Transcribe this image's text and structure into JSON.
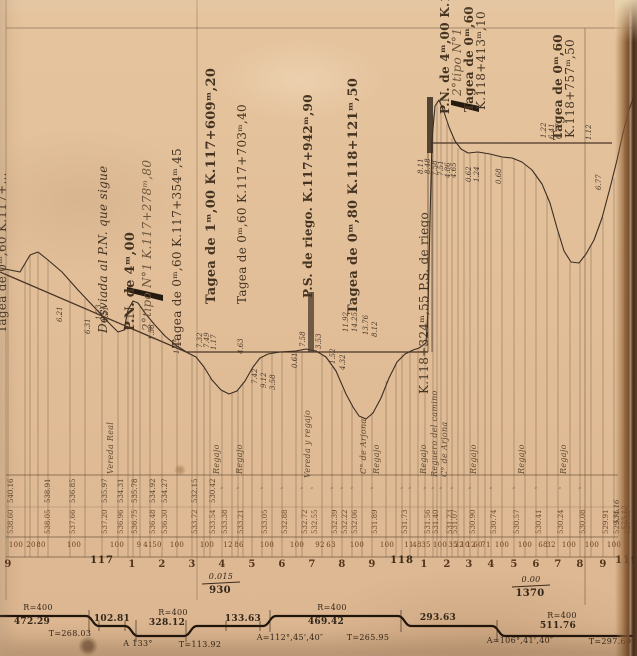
{
  "palette": {
    "paper": "#e2bf99",
    "ink": "#443320",
    "terrain_line": "#3b2e22",
    "grade_line": "#4a3527",
    "band_line": "#20150c",
    "edge_brown": "#55341d"
  },
  "structures": [
    {
      "v": "Tagea de 0ᵐ,60  K.117+…",
      "x": -4,
      "y": 333,
      "c": "s11"
    },
    {
      "v": "Desviada al P.N. que sigue",
      "x": 97,
      "y": 333,
      "c": "i s12"
    },
    {
      "v": "P.N. de 4ᵐ,00",
      "x": 124,
      "y": 331,
      "c": "b s13"
    },
    {
      "v": "2°tipo N°1   K.117+278ᵐ,80",
      "x": 141,
      "y": 331,
      "c": "i s9 faded"
    },
    {
      "v": "Tagea de 0ᵐ,60 K.117+354ᵐ,45",
      "x": 171,
      "y": 348,
      "c": "s12"
    },
    {
      "v": "Tagea de 1ᵐ,00  K.117+609ᵐ,20",
      "x": 205,
      "y": 304,
      "c": "b s13"
    },
    {
      "v": "Tagea de 0ᵐ,60 K.117+703ᵐ,40",
      "x": 236,
      "y": 304,
      "c": "s12"
    },
    {
      "v": "P.S. de riego.  K.117+942ᵐ,90",
      "x": 302,
      "y": 298,
      "c": "b s12"
    },
    {
      "v": "Tagea de 0ᵐ,80  K.118+121ᵐ,50",
      "x": 347,
      "y": 314,
      "c": "b s13"
    },
    {
      "v": "K.118+324ᵐ,55  P.S. de riego",
      "x": 418,
      "y": 394,
      "c": "s9"
    },
    {
      "v": "P.N. de 4ᵐ,00 K.118+403ᵐ,70",
      "x": 439,
      "y": 114,
      "c": "b s9"
    },
    {
      "v": "2°tipo N°1",
      "x": 451,
      "y": 96,
      "c": "i s9 faded"
    },
    {
      "v": "Tagea de 0ᵐ,60",
      "x": 463,
      "y": 112,
      "c": "b s11"
    },
    {
      "v": "K.118+413ᵐ,10",
      "x": 475,
      "y": 110,
      "c": "s9"
    },
    {
      "v": "Tagea de 0ᵐ,60",
      "x": 552,
      "y": 140,
      "c": "b s11"
    },
    {
      "v": "K.118+757ᵐ,50",
      "x": 564,
      "y": 138,
      "c": "s9"
    }
  ],
  "spot_heights": [
    {
      "v": "6.21",
      "x": 57,
      "y": 322
    },
    {
      "v": "6.31",
      "x": 85,
      "y": 334
    },
    {
      "v": "1.23",
      "x": 96,
      "y": 320
    },
    {
      "v": "1.21",
      "x": 103,
      "y": 322
    },
    {
      "v": "1.56",
      "x": 149,
      "y": 340
    },
    {
      "v": "1.85",
      "x": 174,
      "y": 354
    },
    {
      "v": "7.32",
      "x": 197,
      "y": 348
    },
    {
      "v": "7.49",
      "x": 204,
      "y": 348
    },
    {
      "v": "1.17",
      "x": 211,
      "y": 350
    },
    {
      "v": "4.63",
      "x": 238,
      "y": 354
    },
    {
      "v": "7.42",
      "x": 252,
      "y": 384
    },
    {
      "v": "9.12",
      "x": 261,
      "y": 388
    },
    {
      "v": "3.58",
      "x": 270,
      "y": 390
    },
    {
      "v": "0.61",
      "x": 292,
      "y": 368
    },
    {
      "v": "7.58",
      "x": 300,
      "y": 347
    },
    {
      "v": "3.53",
      "x": 316,
      "y": 349
    },
    {
      "v": "1.52",
      "x": 330,
      "y": 364
    },
    {
      "v": "11.92",
      "x": 343,
      "y": 332
    },
    {
      "v": "14.25",
      "x": 352,
      "y": 332
    },
    {
      "v": "13.76",
      "x": 363,
      "y": 335
    },
    {
      "v": "8.12",
      "x": 372,
      "y": 337
    },
    {
      "v": "4.32",
      "x": 340,
      "y": 370
    },
    {
      "v": "8.11",
      "x": 418,
      "y": 174
    },
    {
      "v": "8.48",
      "x": 425,
      "y": 174
    },
    {
      "v": "7.58",
      "x": 432,
      "y": 176
    },
    {
      "v": "7.51",
      "x": 438,
      "y": 176
    },
    {
      "v": "4.86",
      "x": 445,
      "y": 178
    },
    {
      "v": "4.65",
      "x": 451,
      "y": 178
    },
    {
      "v": "0.62",
      "x": 466,
      "y": 182
    },
    {
      "v": "1.24",
      "x": 474,
      "y": 182
    },
    {
      "v": "0.68",
      "x": 496,
      "y": 184
    },
    {
      "v": "1.22",
      "x": 541,
      "y": 138
    },
    {
      "v": "6.41",
      "x": 549,
      "y": 139
    },
    {
      "v": "6.77",
      "x": 556,
      "y": 139
    },
    {
      "v": "1.12",
      "x": 586,
      "y": 140
    },
    {
      "v": "6.77",
      "x": 596,
      "y": 190
    },
    {
      "v": "534.16",
      "x": 614,
      "y": 524,
      "c": "faded"
    },
    {
      "v": "523.12",
      "x": 622,
      "y": 530,
      "c": "faded"
    }
  ],
  "ground_labels": [
    {
      "v": "Vereda Real",
      "x": 107,
      "y": 474
    },
    {
      "v": "Regajo",
      "x": 213,
      "y": 474
    },
    {
      "v": "Regajo",
      "x": 236,
      "y": 474
    },
    {
      "v": "Vereda y regajo",
      "x": 304,
      "y": 478
    },
    {
      "v": "C° de Arjona",
      "x": 360,
      "y": 474
    },
    {
      "v": "Regajo",
      "x": 373,
      "y": 474
    },
    {
      "v": "Regajo",
      "x": 420,
      "y": 474
    },
    {
      "v": "Reguero del camino",
      "x": 431,
      "y": 477,
      "c": "s7"
    },
    {
      "v": "C° de Arjona",
      "x": 441,
      "y": 477,
      "c": "s7"
    },
    {
      "v": "Regajo",
      "x": 470,
      "y": 474
    },
    {
      "v": "Regajo",
      "x": 518,
      "y": 474
    },
    {
      "v": "Regajo",
      "x": 560,
      "y": 474
    }
  ],
  "elev_terrain": [
    {
      "v": "540.16",
      "x": 8,
      "y": 503
    },
    {
      "v": "538.91",
      "x": 45,
      "y": 503
    },
    {
      "v": "536.85",
      "x": 70,
      "y": 503
    },
    {
      "v": "535.97",
      "x": 102,
      "y": 503
    },
    {
      "v": "534.31",
      "x": 118,
      "y": 503
    },
    {
      "v": "535.78",
      "x": 132,
      "y": 503
    },
    {
      "v": "534.92",
      "x": 150,
      "y": 503
    },
    {
      "v": "534.27",
      "x": 162,
      "y": 503
    },
    {
      "v": "532.15",
      "x": 192,
      "y": 503
    },
    {
      "v": "530.42",
      "x": 210,
      "y": 503
    }
  ],
  "elev_grade": [
    {
      "v": "538.60",
      "x": 8,
      "y": 534
    },
    {
      "v": "538.05",
      "x": 45,
      "y": 534
    },
    {
      "v": "537.66",
      "x": 70,
      "y": 534
    },
    {
      "v": "537.20",
      "x": 102,
      "y": 534
    },
    {
      "v": "536.96",
      "x": 118,
      "y": 534
    },
    {
      "v": "536.75",
      "x": 132,
      "y": 534
    },
    {
      "v": "536.48",
      "x": 150,
      "y": 534
    },
    {
      "v": "536.30",
      "x": 162,
      "y": 534
    },
    {
      "v": "533.72",
      "x": 192,
      "y": 534
    },
    {
      "v": "533.54",
      "x": 210,
      "y": 534
    },
    {
      "v": "533.38",
      "x": 222,
      "y": 534
    },
    {
      "v": "533.21",
      "x": 238,
      "y": 534
    },
    {
      "v": "533.05",
      "x": 262,
      "y": 534
    },
    {
      "v": "532.88",
      "x": 282,
      "y": 534
    },
    {
      "v": "532.72",
      "x": 302,
      "y": 534
    },
    {
      "v": "532.55",
      "x": 312,
      "y": 534
    },
    {
      "v": "532.39",
      "x": 332,
      "y": 534
    },
    {
      "v": "532.22",
      "x": 342,
      "y": 534
    },
    {
      "v": "532.06",
      "x": 352,
      "y": 534
    },
    {
      "v": "531.89",
      "x": 372,
      "y": 534
    },
    {
      "v": "531.73",
      "x": 402,
      "y": 534
    },
    {
      "v": "531.56",
      "x": 425,
      "y": 534
    },
    {
      "v": "531.40",
      "x": 433,
      "y": 534
    },
    {
      "v": "531.23",
      "x": 447,
      "y": 534
    },
    {
      "v": "531.07",
      "x": 452,
      "y": 534
    },
    {
      "v": "530.90",
      "x": 470,
      "y": 534
    },
    {
      "v": "530.74",
      "x": 491,
      "y": 534
    },
    {
      "v": "530.57",
      "x": 514,
      "y": 534
    },
    {
      "v": "530.41",
      "x": 536,
      "y": 534
    },
    {
      "v": "530.24",
      "x": 558,
      "y": 534
    },
    {
      "v": "530.08",
      "x": 580,
      "y": 534
    },
    {
      "v": "529.91",
      "x": 603,
      "y": 534
    },
    {
      "v": "529.75",
      "x": 614,
      "y": 534
    },
    {
      "v": "529.58",
      "x": 625,
      "y": 534
    }
  ],
  "ditto_marks": [
    {
      "v": "″",
      "x": 222,
      "y": 488
    },
    {
      "v": "″",
      "x": 238,
      "y": 488
    },
    {
      "v": "″",
      "x": 262,
      "y": 488
    },
    {
      "v": "″",
      "x": 282,
      "y": 488
    },
    {
      "v": "″",
      "x": 302,
      "y": 488
    },
    {
      "v": "″",
      "x": 312,
      "y": 488
    },
    {
      "v": "″",
      "x": 332,
      "y": 488
    },
    {
      "v": "″",
      "x": 342,
      "y": 488
    },
    {
      "v": "″",
      "x": 352,
      "y": 488
    },
    {
      "v": "″",
      "x": 372,
      "y": 488
    },
    {
      "v": "″",
      "x": 402,
      "y": 488
    },
    {
      "v": "″",
      "x": 410,
      "y": 488
    },
    {
      "v": "″",
      "x": 425,
      "y": 488
    },
    {
      "v": "″",
      "x": 433,
      "y": 488
    },
    {
      "v": "″",
      "x": 441,
      "y": 488
    },
    {
      "v": "″",
      "x": 452,
      "y": 488
    },
    {
      "v": "″",
      "x": 470,
      "y": 488
    },
    {
      "v": "″",
      "x": 491,
      "y": 488
    },
    {
      "v": "″",
      "x": 514,
      "y": 488
    },
    {
      "v": "″",
      "x": 536,
      "y": 488
    },
    {
      "v": "″",
      "x": 560,
      "y": 488
    },
    {
      "v": "″",
      "x": 580,
      "y": 488
    }
  ],
  "distances": [
    {
      "v": "100",
      "x": 16,
      "y": 542
    },
    {
      "v": "20",
      "x": 31,
      "y": 542
    },
    {
      "v": "80",
      "x": 41,
      "y": 542
    },
    {
      "v": "100",
      "x": 74,
      "y": 542
    },
    {
      "v": "100",
      "x": 117,
      "y": 542
    },
    {
      "v": "9",
      "x": 139,
      "y": 542
    },
    {
      "v": "41",
      "x": 148,
      "y": 542
    },
    {
      "v": "50",
      "x": 157,
      "y": 542
    },
    {
      "v": "100",
      "x": 177,
      "y": 542
    },
    {
      "v": "100",
      "x": 207,
      "y": 542
    },
    {
      "v": "12",
      "x": 228,
      "y": 542
    },
    {
      "v": "86",
      "x": 239,
      "y": 542
    },
    {
      "v": "100",
      "x": 267,
      "y": 542
    },
    {
      "v": "100",
      "x": 297,
      "y": 542
    },
    {
      "v": "92",
      "x": 320,
      "y": 542
    },
    {
      "v": "63",
      "x": 331,
      "y": 542
    },
    {
      "v": "100",
      "x": 357,
      "y": 542
    },
    {
      "v": "100",
      "x": 387,
      "y": 542
    },
    {
      "v": "11",
      "x": 409,
      "y": 542
    },
    {
      "v": "48",
      "x": 417,
      "y": 542
    },
    {
      "v": "35",
      "x": 426,
      "y": 542
    },
    {
      "v": "100",
      "x": 440,
      "y": 542
    },
    {
      "v": "35",
      "x": 453,
      "y": 542
    },
    {
      "v": "32",
      "x": 459,
      "y": 542
    },
    {
      "v": "10",
      "x": 465,
      "y": 542
    },
    {
      "v": "12",
      "x": 471,
      "y": 542
    },
    {
      "v": "60",
      "x": 478,
      "y": 542
    },
    {
      "v": "71",
      "x": 486,
      "y": 542
    },
    {
      "v": "100",
      "x": 502,
      "y": 542
    },
    {
      "v": "100",
      "x": 525,
      "y": 542
    },
    {
      "v": "68",
      "x": 543,
      "y": 542
    },
    {
      "v": "32",
      "x": 551,
      "y": 542
    },
    {
      "v": "100",
      "x": 569,
      "y": 542
    },
    {
      "v": "100",
      "x": 592,
      "y": 542
    },
    {
      "v": "100",
      "x": 614,
      "y": 542
    }
  ],
  "hectometers": [
    {
      "v": "9",
      "x": 8,
      "y": 560
    },
    {
      "v": "117",
      "x": 102,
      "y": 556,
      "c": "s16 km"
    },
    {
      "v": "1",
      "x": 132,
      "y": 560
    },
    {
      "v": "2",
      "x": 162,
      "y": 560
    },
    {
      "v": "3",
      "x": 192,
      "y": 560
    },
    {
      "v": "4",
      "x": 222,
      "y": 560
    },
    {
      "v": "5",
      "x": 252,
      "y": 560
    },
    {
      "v": "6",
      "x": 282,
      "y": 560
    },
    {
      "v": "7",
      "x": 312,
      "y": 560
    },
    {
      "v": "8",
      "x": 342,
      "y": 560
    },
    {
      "v": "9",
      "x": 372,
      "y": 560
    },
    {
      "v": "118",
      "x": 402,
      "y": 556,
      "c": "s16 km"
    },
    {
      "v": "1",
      "x": 424,
      "y": 560
    },
    {
      "v": "2",
      "x": 447,
      "y": 560
    },
    {
      "v": "3",
      "x": 469,
      "y": 560
    },
    {
      "v": "4",
      "x": 491,
      "y": 560
    },
    {
      "v": "5",
      "x": 514,
      "y": 560
    },
    {
      "v": "6",
      "x": 536,
      "y": 560
    },
    {
      "v": "7",
      "x": 558,
      "y": 560
    },
    {
      "v": "8",
      "x": 580,
      "y": 560
    },
    {
      "v": "9",
      "x": 603,
      "y": 560
    },
    {
      "v": "119",
      "x": 627,
      "y": 556,
      "c": "s16 km"
    }
  ],
  "gradients": [
    {
      "v": "0.015",
      "x": 221,
      "y": 573,
      "c": "i s8 ctr"
    },
    {
      "v": "930",
      "x": 220,
      "y": 586,
      "c": "b s10 ctr"
    },
    {
      "v": "0.00",
      "x": 531,
      "y": 576,
      "c": "i s8 ctr"
    },
    {
      "v": "1370",
      "x": 530,
      "y": 589,
      "c": "b s10 ctr"
    }
  ],
  "alignment_labels": [
    {
      "v": "R=400",
      "x": 38,
      "y": 604,
      "c": "s8 ctr"
    },
    {
      "v": "472.29",
      "x": 32,
      "y": 618,
      "c": "b s9 ctr"
    },
    {
      "v": "T=268.03",
      "x": 70,
      "y": 630,
      "c": "s8 ctr"
    },
    {
      "v": "102.81",
      "x": 112,
      "y": 615,
      "c": "b s9 ctr"
    },
    {
      "v": "R=400",
      "x": 173,
      "y": 609,
      "c": "s8 ctr"
    },
    {
      "v": "328.12",
      "x": 167,
      "y": 619,
      "c": "b s9 ctr"
    },
    {
      "v": "A 133°",
      "x": 138,
      "y": 640,
      "c": "s8 ctr"
    },
    {
      "v": "T=113.92",
      "x": 200,
      "y": 641,
      "c": "s8 ctr"
    },
    {
      "v": "133.63",
      "x": 243,
      "y": 615,
      "c": "b s9 ctr"
    },
    {
      "v": "R=400",
      "x": 332,
      "y": 604,
      "c": "s8 ctr"
    },
    {
      "v": "469.42",
      "x": 326,
      "y": 618,
      "c": "b s9 ctr"
    },
    {
      "v": "A=112°,45',40″",
      "x": 290,
      "y": 634,
      "c": "s8 ctr"
    },
    {
      "v": "T=265.95",
      "x": 368,
      "y": 634,
      "c": "s8 ctr"
    },
    {
      "v": "293.63",
      "x": 438,
      "y": 614,
      "c": "b s9 ctr"
    },
    {
      "v": "R=400",
      "x": 562,
      "y": 612,
      "c": "s8 ctr"
    },
    {
      "v": "511.76",
      "x": 558,
      "y": 622,
      "c": "b s9 ctr"
    },
    {
      "v": "A=106°,41',40″",
      "x": 520,
      "y": 637,
      "c": "s8 ctr"
    },
    {
      "v": "T=297.69",
      "x": 610,
      "y": 638,
      "c": "s8 ctr"
    }
  ]
}
